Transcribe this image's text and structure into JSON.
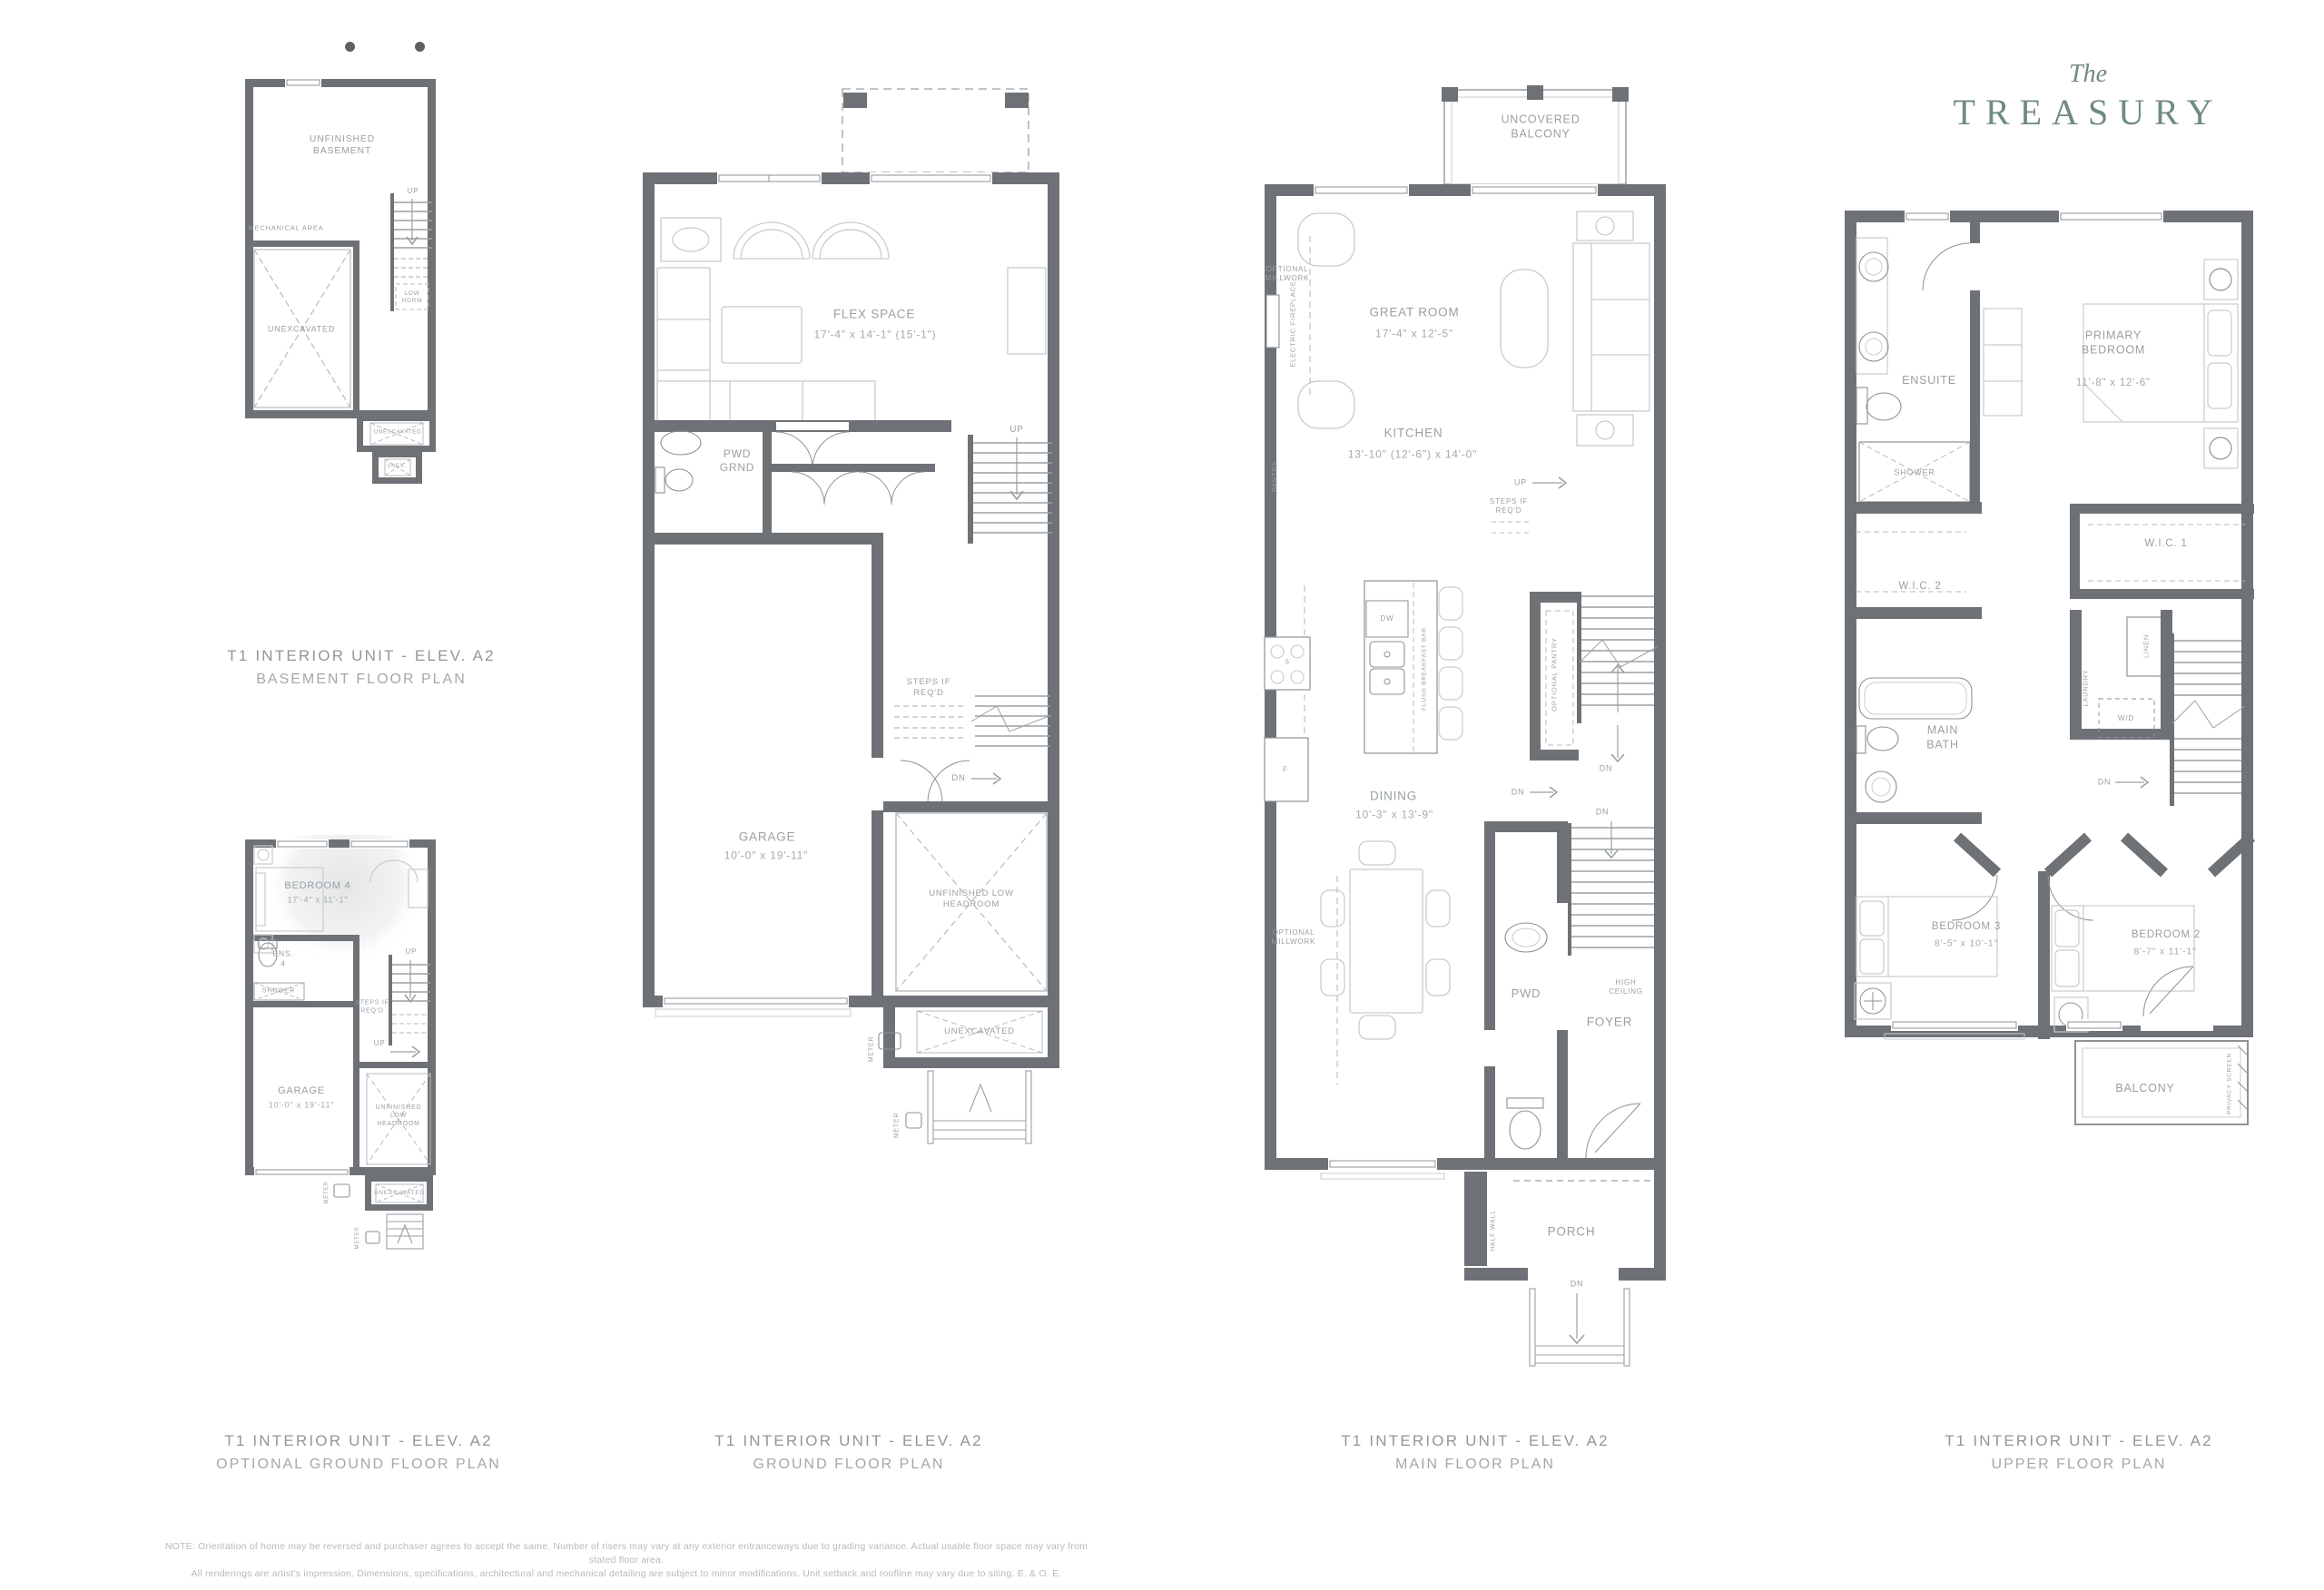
{
  "logo": {
    "prefix": "The",
    "name": "TREASURY"
  },
  "plans": {
    "basement": {
      "title": "T1 INTERIOR UNIT - ELEV. A2",
      "subtitle": "BASEMENT FLOOR PLAN",
      "labels": {
        "unfinished_basement": "UNFINISHED BASEMENT",
        "mechanical_area": "MECHANICAL AREA",
        "up": "UP",
        "low_hdrm": "LOW HDRM",
        "unexcavated": "UNEXCAVATED",
        "unexcavated_small": "UNEXCAVATED",
        "unex_tiny": "UNEX."
      }
    },
    "optional_ground": {
      "title": "T1 INTERIOR UNIT - ELEV. A2",
      "subtitle": "OPTIONAL GROUND FLOOR PLAN",
      "labels": {
        "bedroom4_name": "BEDROOM 4",
        "bedroom4_dims": "17'-4\" x 11'-1\"",
        "ens4": "ENS. 4",
        "shower": "SHOWER",
        "steps_if_reqd": "STEPS IF REQ'D",
        "up": "UP",
        "garage_name": "GARAGE",
        "garage_dims": "10'-0\" x 19'-11\"",
        "unfinished_low_headroom": "UNFINISHED LOW HEADROOM",
        "unexcavated": "UNEXCAVATED",
        "meter": "METER"
      }
    },
    "ground": {
      "title": "T1 INTERIOR UNIT - ELEV. A2",
      "subtitle": "GROUND FLOOR PLAN",
      "labels": {
        "flex_name": "FLEX SPACE",
        "flex_dims": "17'-4\" x 14'-1\" (15'-1\")",
        "pwd_grnd": "PWD GRND",
        "up": "UP",
        "steps_if_reqd": "STEPS IF REQ'D",
        "dn": "DN",
        "garage_name": "GARAGE",
        "garage_dims": "10'-0\" x 19'-11\"",
        "unfinished_low_headroom": "UNFINISHED LOW HEADROOM",
        "unexcavated": "UNEXCAVATED",
        "meter": "METER"
      }
    },
    "main": {
      "title": "T1 INTERIOR UNIT - ELEV. A2",
      "subtitle": "MAIN FLOOR PLAN",
      "labels": {
        "uncovered_balcony": "UNCOVERED BALCONY",
        "optional_millwork": "OPTIONAL MILLWORK",
        "electric_fireplace": "ELECTRIC FIREPLACE",
        "great_room_name": "GREAT ROOM",
        "great_room_dims": "17'-4\" x 12'-5\"",
        "kitchen_name": "KITCHEN",
        "kitchen_dims": "13'-10\" (12'-6\") x 14'-0\"",
        "pantry": "PANTRY",
        "up": "UP",
        "steps_if_reqd": "STEPS IF REQ'D",
        "dw": "DW",
        "flush_breakfast_bar": "FLUSH BREAKFAST BAR",
        "stove": "S",
        "fridge": "F",
        "optional_pantry": "OPTIONAL PANTRY",
        "dn": "DN",
        "dining_name": "DINING",
        "dining_dims": "10'-3\" x 13'-9\"",
        "pwd": "PWD",
        "high_ceiling": "HIGH CEILING",
        "foyer": "FOYER",
        "half_wall": "HALF WALL",
        "porch": "PORCH"
      }
    },
    "upper": {
      "title": "T1 INTERIOR UNIT - ELEV. A2",
      "subtitle": "UPPER FLOOR PLAN",
      "labels": {
        "ensuite": "ENSUITE",
        "shower": "SHOWER",
        "primary_name": "PRIMARY BEDROOM",
        "primary_dims": "11'-8\" x 12'-6\"",
        "wic1": "W.I.C. 1",
        "wic2": "W.I.C. 2",
        "main_bath": "MAIN BATH",
        "laundry": "LAUNDRY",
        "linen": "LINEN",
        "wd": "W/D",
        "dn": "DN",
        "bedroom3_name": "BEDROOM 3",
        "bedroom3_dims": "8'-5\" x 10'-1\"",
        "bedroom2_name": "BEDROOM 2",
        "bedroom2_dims": "8'-7\" x 11'-1\"",
        "balcony": "BALCONY",
        "privacy_screen": "PRIVACY SCREEN"
      }
    }
  },
  "footnote": {
    "line1": "NOTE: Orientation of home may be reversed and purchaser agrees to accept the same. Number of risers may vary at any exterior entranceways due to grading variance. Actual usable floor space may vary from stated floor area.",
    "line2": "All renderings are artist's impression. Dimensions, specifications, architectural and mechanical detailing are subject to minor modifications. Unit setback and roofline may vary due to siting. E. & O. E."
  },
  "colors": {
    "wall": "#6e7276",
    "mid_line": "#8d9296",
    "furniture_line": "#c9cccd",
    "dash_line": "#b7bbbd",
    "label_text": "#9aa0a4",
    "title_text": "#8f979d",
    "logo_green": "#6f8b7e",
    "footnote_text": "#b6babd"
  }
}
